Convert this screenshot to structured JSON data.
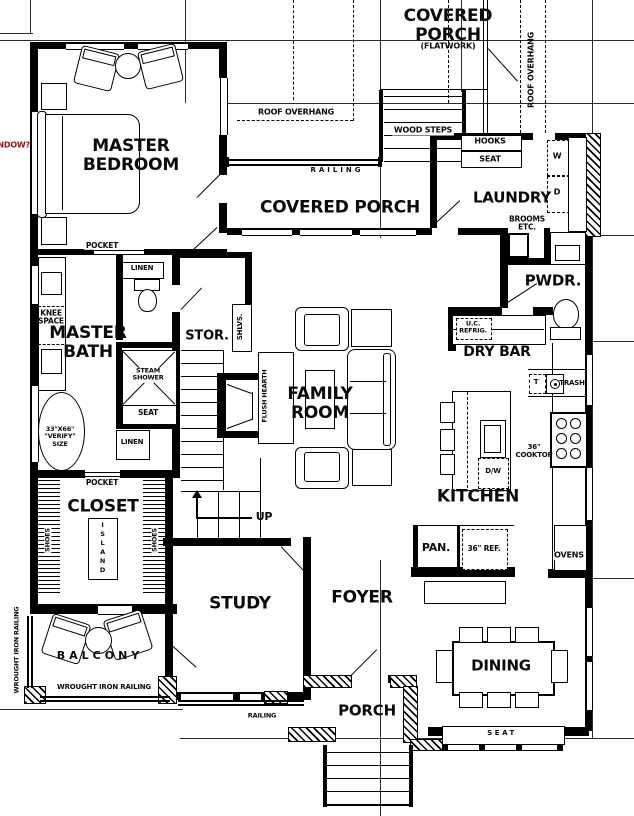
{
  "plan": {
    "rooms": {
      "master_bedroom": "MASTER BEDROOM",
      "covered_porch_upper": "COVERED PORCH",
      "covered_porch_mid": "COVERED PORCH",
      "laundry": "LAUNDRY",
      "powder": "PWDR.",
      "master_bath": "MASTER BATH",
      "storage": "STOR.",
      "family_room": "FAMILY ROOM",
      "dry_bar": "DRY BAR",
      "kitchen": "KITCHEN",
      "closet": "CLOSET",
      "study": "STUDY",
      "foyer": "FOYER",
      "balcony": "BALCONY",
      "porch": "PORCH",
      "dining": "DINING"
    },
    "annotations": {
      "flatwork": "(FLATWORK)",
      "roof_overhang_top": "ROOF OVERHANG",
      "roof_overhang_right": "ROOF OVERHANG",
      "wood_steps": "WOOD STEPS",
      "hooks": "HOOKS",
      "seat_mud": "SEAT",
      "brooms": "BROOMS\nETC.",
      "railing_top": "RAILING",
      "railing_porch": "RAILING",
      "window_query": "WINDOW?",
      "pocket_master": "POCKET",
      "pocket_closet": "POCKET",
      "linen_upper": "LINEN",
      "linen_lower": "LINEN",
      "knee_space": "KNEE\nSPACE",
      "steam_shower": "STEAM\nSHOWER",
      "shower_seat": "SEAT",
      "tub_note": "33\"X66\"\n\"VERIFY\"\nSIZE",
      "shelves": "SHLVS.",
      "flush_hearth": "FLUSH HEARTH",
      "uc_refrig": "U.C.\nREFRIG.",
      "up": "UP",
      "island": "ISLAND",
      "shoes_left": "SHOES",
      "shoes_right": "SHOES",
      "wrought_iron_left": "WROUGHT IRON RAILING",
      "wrought_iron_bottom": "WROUGHT IRON RAILING",
      "dining_seat": "SEAT"
    },
    "fixtures": {
      "washer": "W",
      "dryer": "D",
      "trash_pullout": "T",
      "trash": "TRASH",
      "cooktop": "36\"\nCOOKTOP",
      "dishwasher": "D/W",
      "pantry": "PAN.",
      "refrigerator": "36\" REF.",
      "ovens": "OVENS"
    },
    "colors": {
      "walls": "#000000",
      "note_red": "#8a1515",
      "background": "#ffffff"
    }
  }
}
